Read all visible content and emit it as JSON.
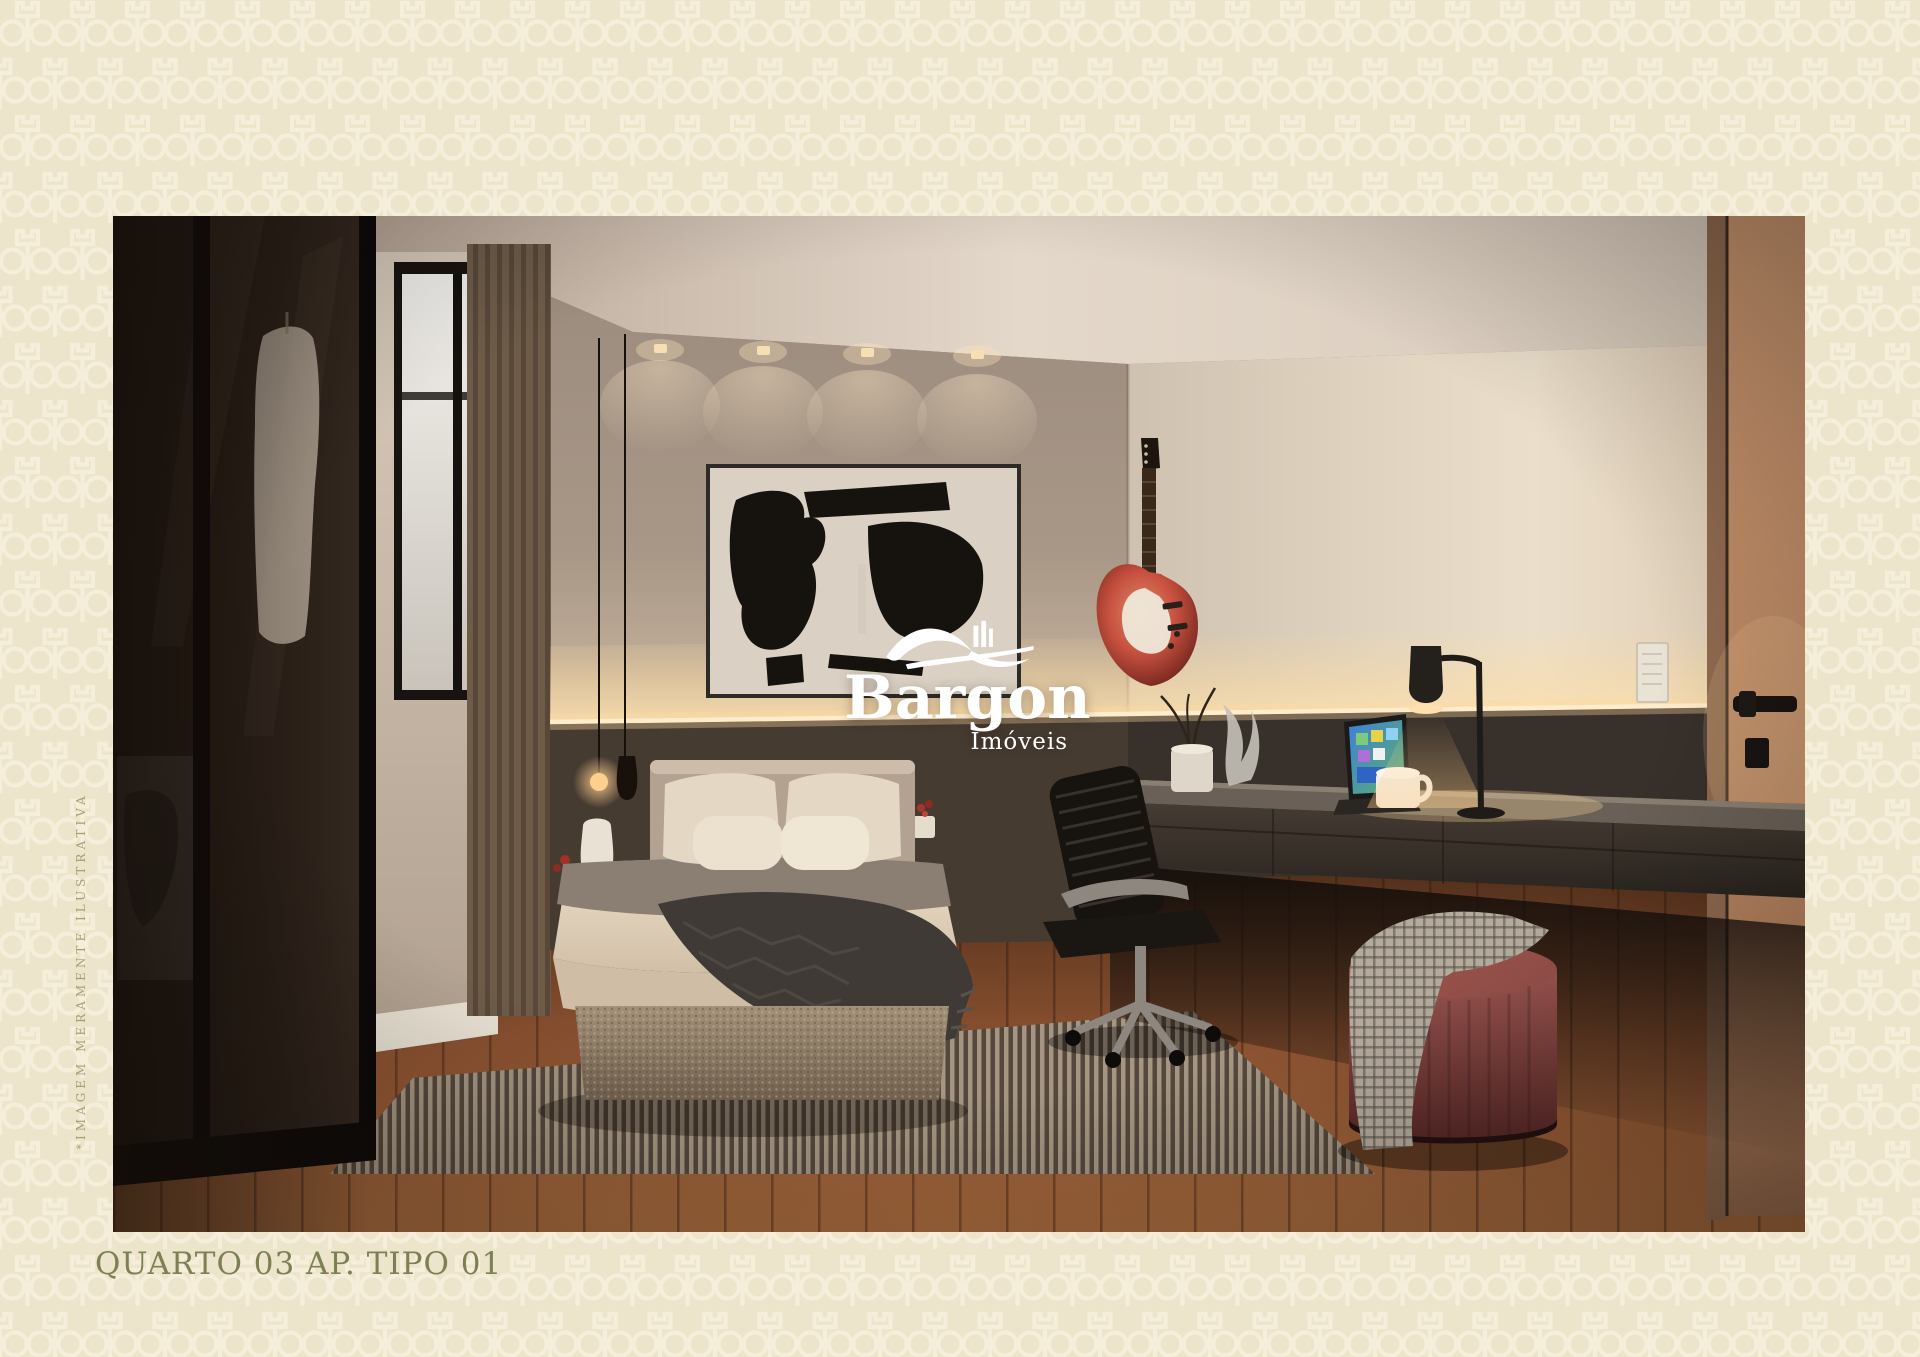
{
  "page": {
    "background_color": "#ece4cb",
    "pattern_name": "tulip-outline-wallpaper",
    "pattern_color": "#f5eedb"
  },
  "watermark": {
    "brand": "Bargon",
    "subtitle": "Imóveis",
    "icon": "bridge-skyline-icon",
    "color": "#ffffff"
  },
  "caption": {
    "text": "QUARTO 03 AP. TIPO 01",
    "color": "#7c8054"
  },
  "disclaimer": {
    "text": "*IMAGEM MERAMENTE ILUSTRATIVA",
    "color": "#a89e73"
  },
  "colors": {
    "page_background": "#ece4cb",
    "pattern": "#f5eedb",
    "caption": "#7c8054",
    "disclaimer": "#a89e73",
    "watermark": "#ffffff",
    "led_accent": "#ffdf9e",
    "pouf_red": "#8c4a45",
    "wood_floor": "#8a5130"
  },
  "photo": {
    "type": "interior-render",
    "room": "bedroom",
    "objects": [
      "smoked-glass-wardrobe",
      "window-with-sheer",
      "striped-curtain",
      "abstract-wall-art",
      "pendant-bulb-lamp",
      "nightstand",
      "double-bed",
      "herringbone-throw",
      "striped-rug",
      "electric-guitar",
      "led-strip-light",
      "floating-desk",
      "desk-lamp",
      "laptop",
      "mug",
      "plant-pot",
      "office-chair",
      "red-pouf",
      "checkered-blanket",
      "ceiling-spotlights",
      "light-switch",
      "door-with-black-handle",
      "wood-floor"
    ]
  }
}
